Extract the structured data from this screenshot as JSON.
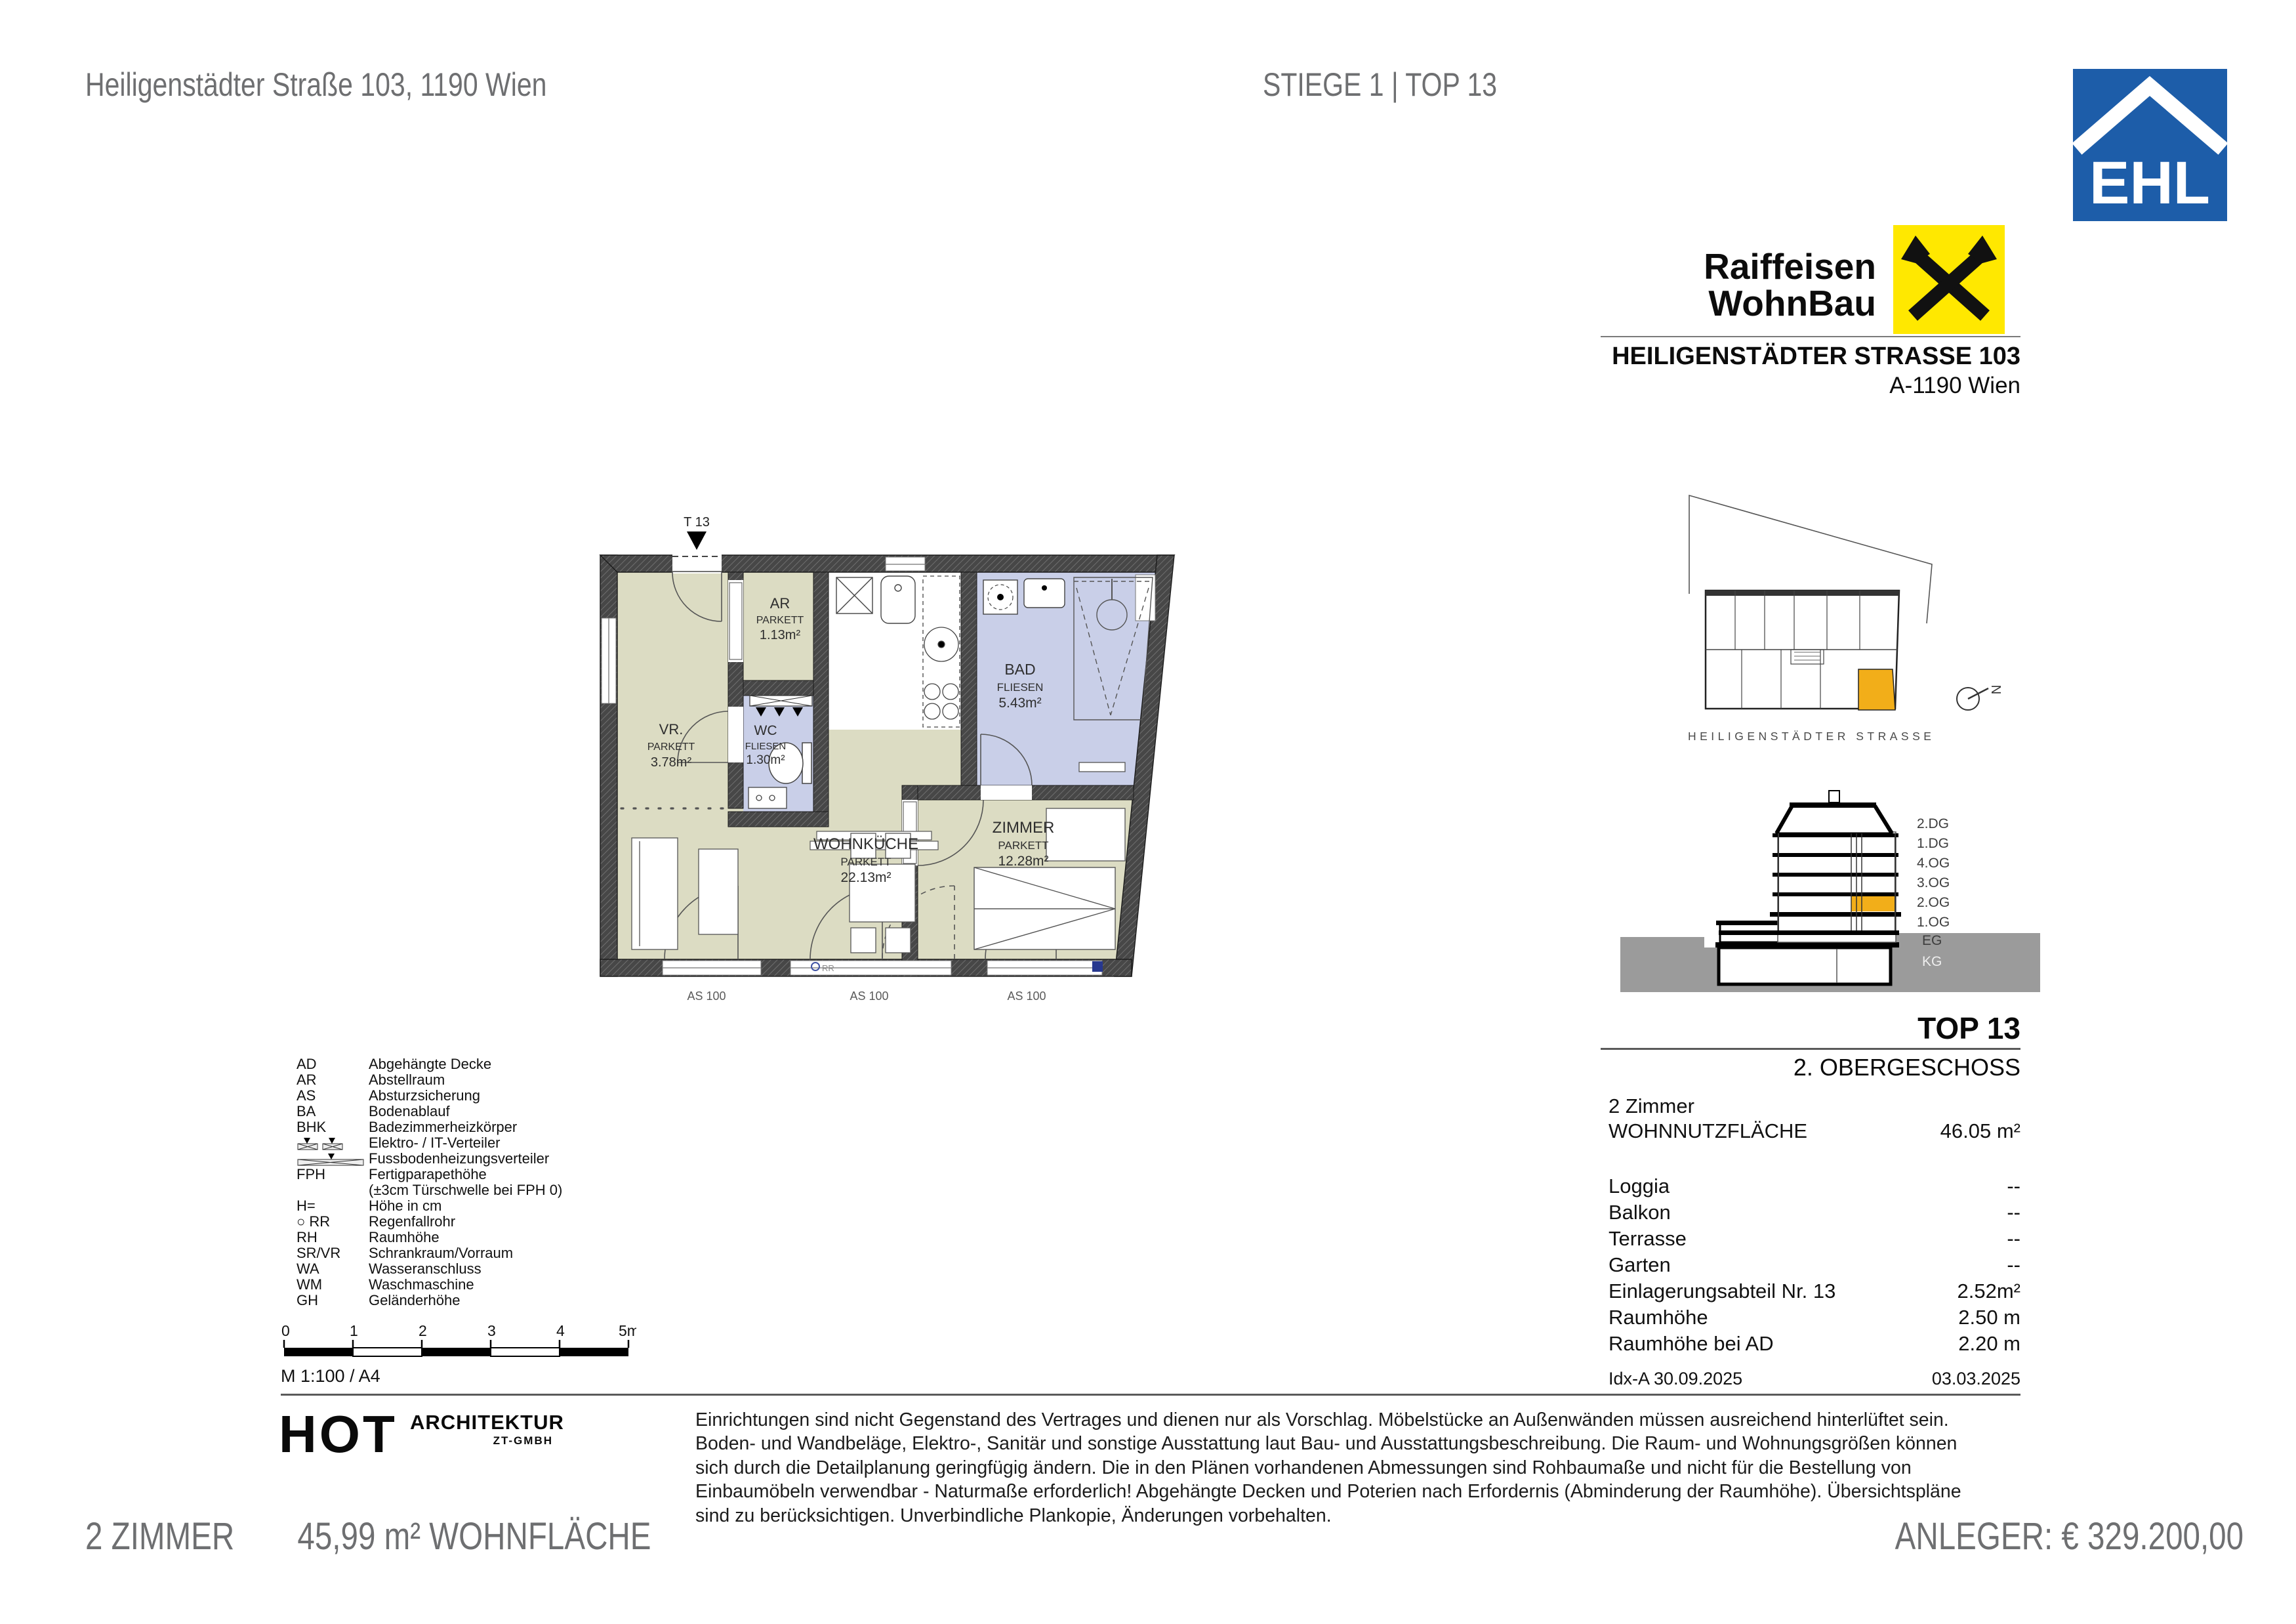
{
  "page": {
    "address_header": "Heiligenstädter Straße 103, 1190 Wien",
    "unit_header": "STIEGE 1 | TOP 13",
    "footer_rooms": "2 ZIMMER",
    "footer_area": "45,99 m² WOHNFLÄCHE",
    "footer_price": "ANLEGER: € 329.200,00"
  },
  "branding": {
    "ehl_text": "EHL",
    "ehl_blue": "#1d5da9",
    "raiffeisen_line1": "Raiffeisen",
    "raiffeisen_line2": "WohnBau",
    "raiffeisen_yellow": "#ffe800",
    "project_name": "HEILIGENSTÄDTER STRASSE 103",
    "project_city": "A-1190 Wien"
  },
  "site_plan": {
    "street_label": "HEILIGENSTÄDTER STRASSE",
    "north_letter": "N",
    "highlight_color": "#f2ae19"
  },
  "section": {
    "floors": [
      "2.DG",
      "1.DG",
      "4.OG",
      "3.OG",
      "2.OG",
      "1.OG",
      "EG",
      "KG"
    ],
    "highlight_floor": "2.OG"
  },
  "unit_info": {
    "top_label": "TOP 13",
    "floor_label": "2. OBERGESCHOSS",
    "rooms_count": "2 Zimmer",
    "area_label": "WOHNNUTZFLÄCHE",
    "area_value": "46.05 m²",
    "rows": [
      {
        "label": "Loggia",
        "value": "--"
      },
      {
        "label": "Balkon",
        "value": "--"
      },
      {
        "label": "Terrasse",
        "value": "--"
      },
      {
        "label": "Garten",
        "value": "--"
      },
      {
        "label": "Einlagerungsabteil Nr. 13",
        "value": "2.52m²"
      },
      {
        "label": "Raumhöhe",
        "value": "2.50 m"
      },
      {
        "label": "Raumhöhe bei AD",
        "value": "2.20 m"
      }
    ],
    "index_label": "Idx-A 30.09.2025",
    "date": "03.03.2025"
  },
  "floorplan": {
    "entrance_label": "T 13",
    "rooms": [
      {
        "name": "VR.",
        "material": "PARKETT",
        "area": "3.78m²"
      },
      {
        "name": "AR",
        "material": "PARKETT",
        "area": "1.13m²"
      },
      {
        "name": "WC",
        "material": "FLIESEN",
        "area": "1.30m²"
      },
      {
        "name": "BAD",
        "material": "FLIESEN",
        "area": "5.43m²"
      },
      {
        "name": "WOHNKÜCHE",
        "material": "PARKETT",
        "area": "22.13m²"
      },
      {
        "name": "ZIMMER",
        "material": "PARKETT",
        "area": "12.28m²"
      }
    ],
    "window_labels": [
      "AS 100",
      "AS 100",
      "AS 100"
    ],
    "rr_label": "RR",
    "colors": {
      "parkett": "#dcdcc3",
      "fliesen": "#c9cfe8",
      "wall": "#474747"
    }
  },
  "legend": {
    "items": [
      {
        "abbr": "AD",
        "desc": "Abgehängte Decke"
      },
      {
        "abbr": "AR",
        "desc": "Abstellraum"
      },
      {
        "abbr": "AS",
        "desc": "Absturzsicherung"
      },
      {
        "abbr": "BA",
        "desc": "Bodenablauf"
      },
      {
        "abbr": "BHK",
        "desc": "Badezimmerheizkörper"
      },
      {
        "abbr": "",
        "desc": "Elektro- / IT-Verteiler"
      },
      {
        "abbr": "",
        "desc": "Fussbodenheizungsverteiler"
      },
      {
        "abbr": "FPH",
        "desc": "Fertigparapethöhe"
      },
      {
        "abbr": "",
        "desc": "(±3cm Türschwelle bei FPH 0)"
      },
      {
        "abbr": "H=",
        "desc": "Höhe in cm"
      },
      {
        "abbr": "○ RR",
        "desc": "Regenfallrohr"
      },
      {
        "abbr": "RH",
        "desc": "Raumhöhe"
      },
      {
        "abbr": "SR/VR",
        "desc": "Schrankraum/Vorraum"
      },
      {
        "abbr": "WA",
        "desc": "Wasseranschluss"
      },
      {
        "abbr": "WM",
        "desc": "Waschmaschine"
      },
      {
        "abbr": "GH",
        "desc": "Geländerhöhe"
      }
    ]
  },
  "scalebar": {
    "ticks": [
      "0",
      "1",
      "2",
      "3",
      "4",
      "5m"
    ],
    "caption": "M 1:100 / A4"
  },
  "architect": {
    "name": "HOT",
    "sub1": "ARCHITEKTUR",
    "sub2": "ZT-GMBH"
  },
  "disclaimer": {
    "text": "Einrichtungen sind nicht Gegenstand des Vertrages und dienen nur als Vorschlag. Möbelstücke an Außenwänden müssen ausreichend hinterlüftet sein. Boden- und Wandbeläge, Elektro-, Sanitär und sonstige Ausstattung laut Bau- und Ausstattungsbeschreibung. Die Raum- und Wohnungsgrößen können sich durch die Detailplanung geringfügig ändern. Die in den Plänen vorhandenen Abmessungen sind Rohbaumaße und nicht für die Bestellung von Einbaumöbeln verwendbar - Naturmaße erforderlich! Abgehängte Decken und Poterien nach Erfordernis (Abminderung der Raumhöhe). Übersichtspläne sind zu berücksichtigen. Unverbindliche Plankopie, Änderungen vorbehalten."
  }
}
